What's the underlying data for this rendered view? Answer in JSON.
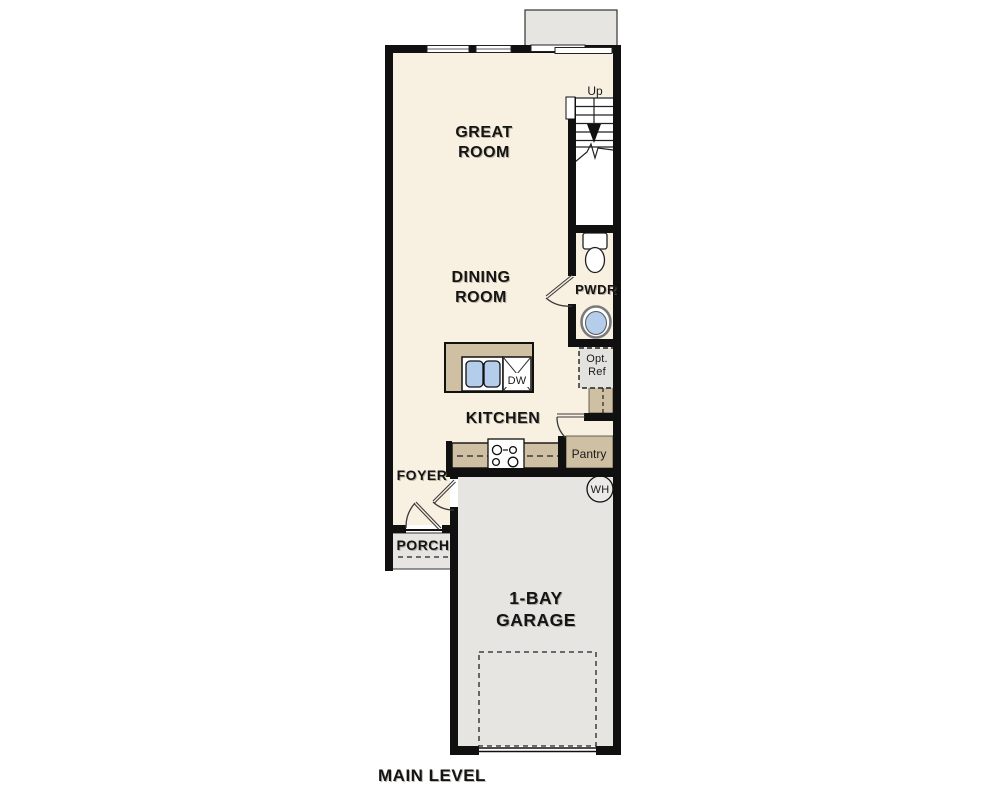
{
  "plan": {
    "title": "MAIN LEVEL"
  },
  "rooms": {
    "great_room": {
      "label_lines": [
        "GREAT",
        "ROOM"
      ]
    },
    "dining_room": {
      "label_lines": [
        "DINING",
        "ROOM"
      ]
    },
    "kitchen": {
      "label": "KITCHEN"
    },
    "foyer": {
      "label": "FOYER"
    },
    "porch": {
      "label": "PORCH"
    },
    "powder_room": {
      "label": "PWDR"
    },
    "pantry": {
      "label": "Pantry"
    },
    "garage": {
      "label_lines": [
        "1-BAY",
        "GARAGE"
      ]
    }
  },
  "annotations": {
    "stairs_direction": "Up",
    "dishwasher": "DW",
    "water_heater": "WH",
    "optional_refrigerator_lines": [
      "Opt.",
      "Ref"
    ]
  },
  "colors": {
    "interior_floor": "#f8f0e1",
    "casework_tan": "#cfc0a3",
    "concrete_gray": "#e6e5e2",
    "fixture_blue": "#b3cdea",
    "wall_black": "#101010"
  }
}
